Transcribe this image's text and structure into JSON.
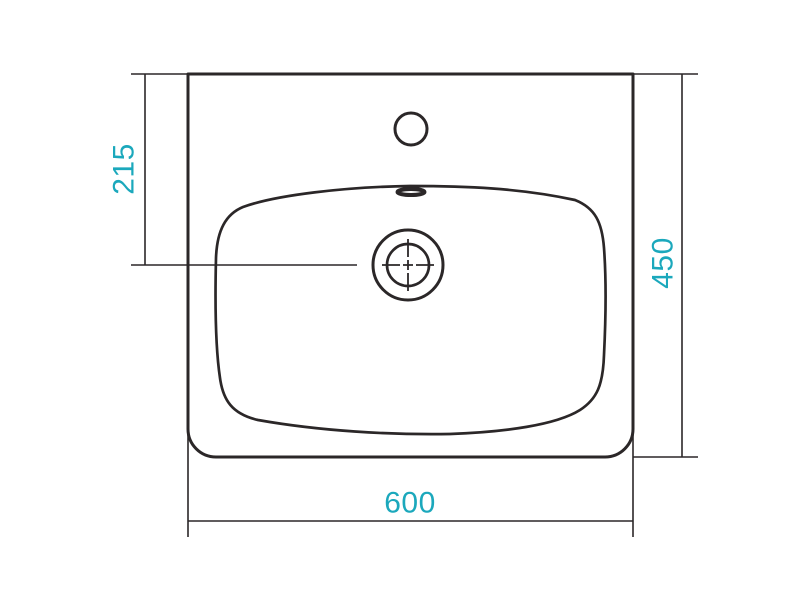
{
  "colors": {
    "accent": "#1ba8bc",
    "line": "#2b2728",
    "background": "#ffffff"
  },
  "dimensions": {
    "drain_center_from_top": {
      "label": "215"
    },
    "overall_depth": {
      "label": "450"
    },
    "overall_width": {
      "label": "600"
    }
  }
}
